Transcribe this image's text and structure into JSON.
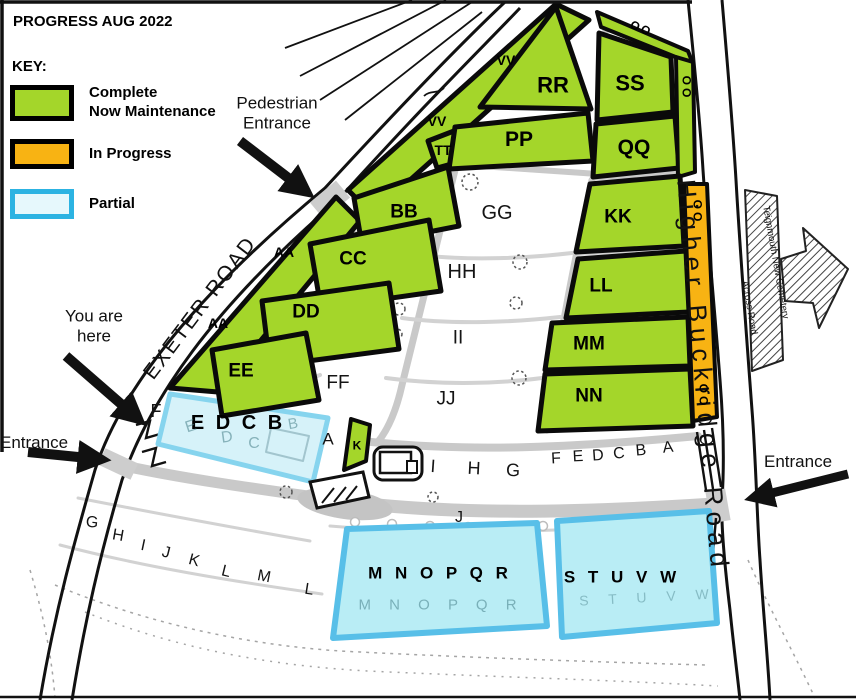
{
  "title": "PROGRESS AUG 2022",
  "key": {
    "heading": "KEY:",
    "items": [
      {
        "label": "Complete\nNow Maintenance",
        "fill": "#a4d62a",
        "border": "#000000"
      },
      {
        "label": "In Progress",
        "fill": "#f8b313",
        "border": "#000000"
      },
      {
        "label": "Partial",
        "fill": "#e6f8fc",
        "border": "#2cb3e2"
      }
    ]
  },
  "roads": {
    "exeter": "EXETER ROAD",
    "buckridge": "Higher Buckridge Road"
  },
  "sign": {
    "line1": "Teignmouth New Cemetery",
    "line2": "Across Road"
  },
  "annotations": {
    "pedestrian": "Pedestrian\nEntrance",
    "you_are_here": "You are\nhere",
    "entrance_left": "Entrance",
    "entrance_right": "Entrance"
  },
  "sections": {
    "aa": "AA",
    "vv": "VV",
    "tt": "TT",
    "bb": "BB",
    "cc": "CC",
    "dd": "DD",
    "ee": "EE",
    "ff": "FF",
    "gg": "GG",
    "hh": "HH",
    "ii": "II",
    "jj": "JJ",
    "kk": "KK",
    "ll": "LL",
    "mm": "MM",
    "nn": "NN",
    "pp": "PP",
    "qq": "QQ",
    "rr": "RR",
    "ss": "SS",
    "oo": "OO",
    "k": "K",
    "f": "F",
    "a": "A",
    "j": "J",
    "edcb": "E D C B",
    "mnopqr": "M N O P Q R",
    "stuvw": "S T U V W"
  },
  "faint": {
    "e": "E",
    "d": "D",
    "c": "C",
    "b": "B",
    "mnopqr": "M N O P Q R",
    "stuvw": "S T U V W"
  },
  "plots": {
    "bottom": [
      "G",
      "H",
      "I",
      "J",
      "K",
      "L",
      "M",
      "L"
    ],
    "mid": [
      "I",
      "H",
      "G"
    ],
    "right": [
      "F",
      "E",
      "D",
      "C",
      "B",
      "A"
    ]
  }
}
